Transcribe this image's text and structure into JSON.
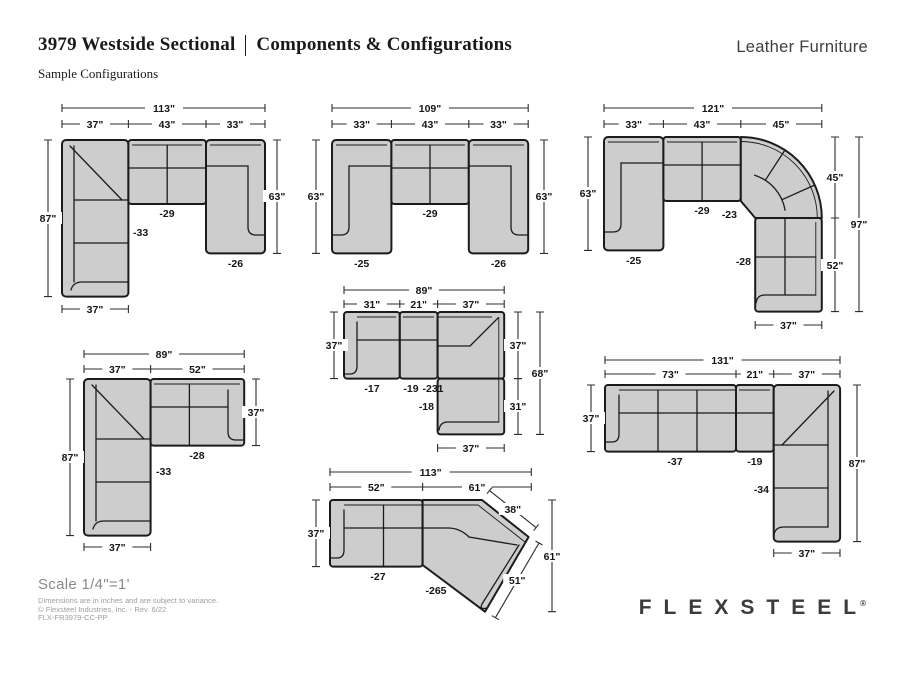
{
  "header": {
    "title_left": "3979 Westside Sectional",
    "title_right": "Components & Configurations",
    "brand_tag": "Leather Furniture",
    "subtitle": "Sample Configurations"
  },
  "colors": {
    "sofa_fill": "#cdcdcd",
    "line": "#1b1b1b",
    "footer_gray": "#8a8a8a"
  },
  "diagrams": {
    "a": {
      "total": "113\"",
      "seg1": "37\"",
      "seg2": "43\"",
      "seg3": "33\"",
      "left": "87\"",
      "right": "63\"",
      "bottom": "37\"",
      "p1": "-33",
      "p2": "-29",
      "p3": "-26"
    },
    "b": {
      "total": "109\"",
      "seg1": "33\"",
      "seg2": "43\"",
      "seg3": "33\"",
      "left": "63\"",
      "right": "63\"",
      "p1": "-25",
      "p2": "-29",
      "p3": "-26"
    },
    "c": {
      "total": "121\"",
      "seg1": "33\"",
      "seg2": "43\"",
      "seg3": "45\"",
      "left": "63\"",
      "right_upper": "45\"",
      "right_lower": "52\"",
      "right_total": "97\"",
      "bottom": "37\"",
      "p1": "-25",
      "p2": "-29",
      "p3": "-23",
      "p4": "-28"
    },
    "d": {
      "total": "89\"",
      "seg1": "31\"",
      "seg2": "21\"",
      "seg3": "37\"",
      "left": "37\"",
      "right_upper": "37\"",
      "right_lower": "31\"",
      "right_total": "68\"",
      "bottom": "37\"",
      "p1": "-17",
      "p2": "-19",
      "p3": "-231",
      "p4": "-18"
    },
    "e": {
      "total": "89\"",
      "seg1": "37\"",
      "seg2": "52\"",
      "left": "87\"",
      "right": "37\"",
      "bottom": "37\"",
      "p1": "-33",
      "p2": "-28"
    },
    "f": {
      "total": "113\"",
      "seg1": "52\"",
      "seg2": "61\"",
      "left": "37\"",
      "edge_upper": "38\"",
      "edge_lower": "51\"",
      "right": "61\"",
      "p1": "-27",
      "p2": "-265"
    },
    "g": {
      "total": "131\"",
      "seg1": "73\"",
      "seg2": "21\"",
      "seg3": "37\"",
      "left": "37\"",
      "right": "87\"",
      "bottom": "37\"",
      "p1": "-37",
      "p2": "-19",
      "p3": "-34"
    }
  },
  "footer": {
    "scale": "Scale 1/4\"=1'",
    "note1": "Dimensions are in inches and are subject to variance.",
    "note2": "© Flexsteel Industries, Inc. - Rev. 6/22",
    "note3": "FLX-FR3979-CC-PP",
    "logo": "FLEXSTEEL",
    "logo_reg": "®"
  }
}
